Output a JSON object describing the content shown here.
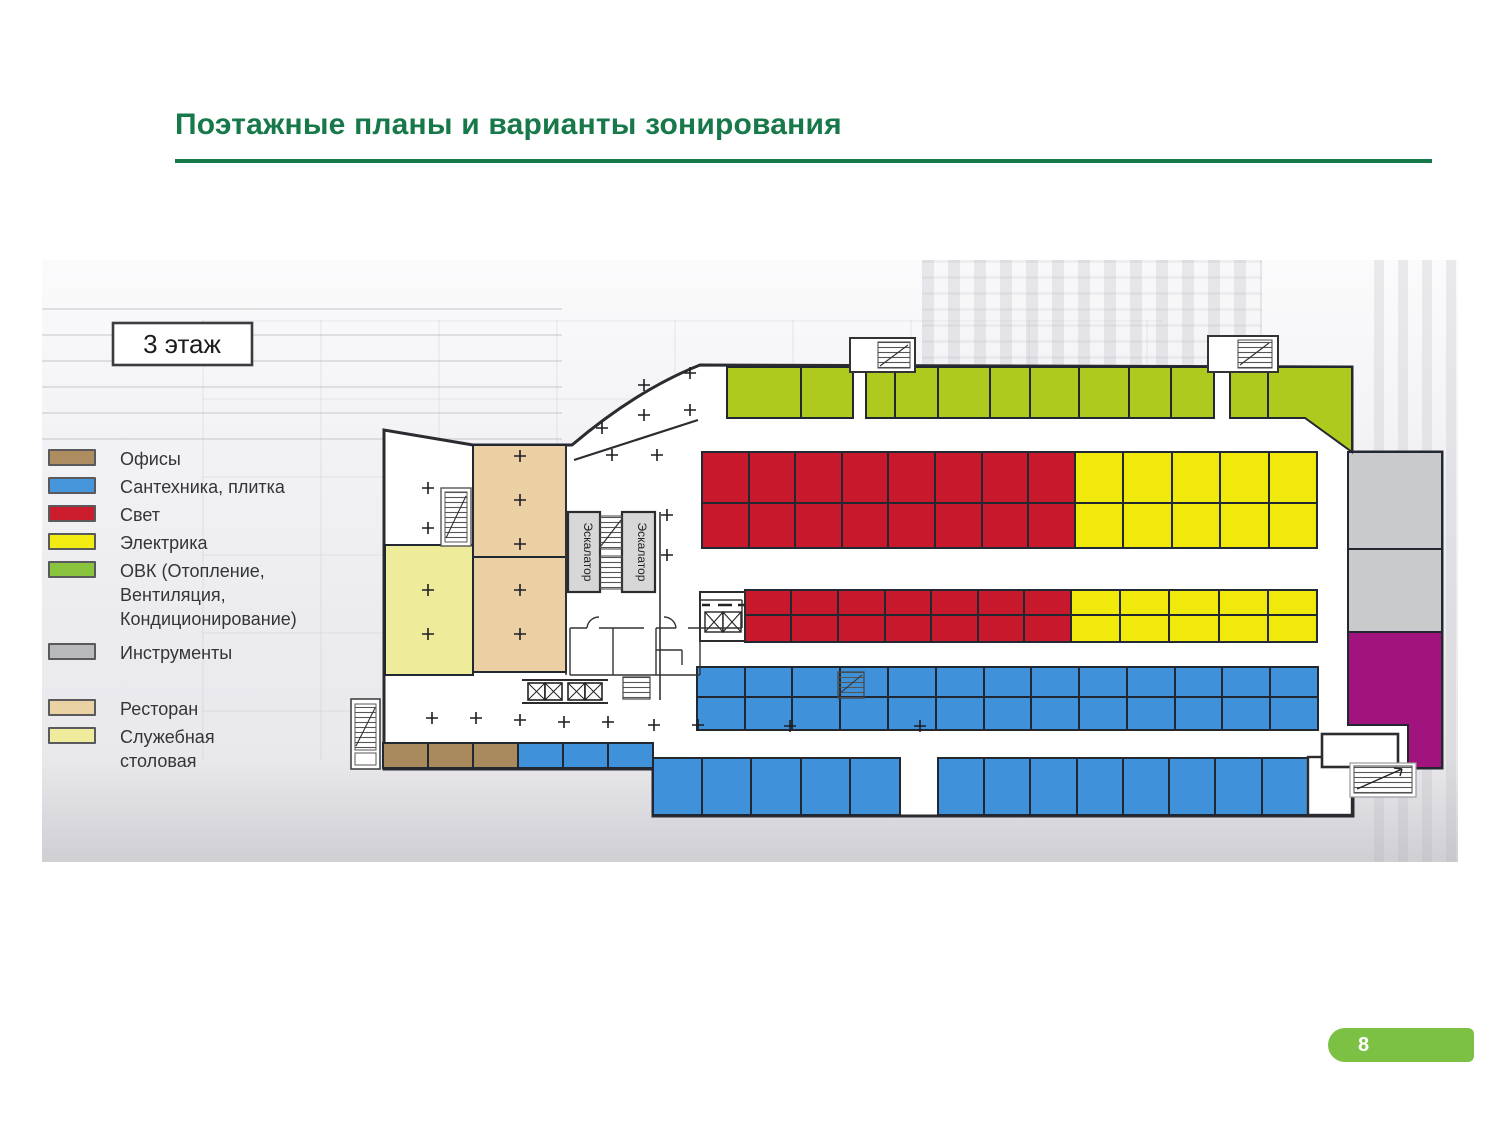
{
  "page": {
    "title": "Поэтажные планы и варианты зонирования",
    "accent_green": "#17784a",
    "badge_green": "#7cc143",
    "page_number": "8"
  },
  "plan": {
    "floor_label": "3 этаж",
    "escalator_label": "Эскалатор",
    "legend": [
      {
        "id": "offices",
        "label": "Офисы",
        "color": "#ad8c60"
      },
      {
        "id": "plumbing",
        "label": "Сантехника, плитка",
        "color": "#4796dc"
      },
      {
        "id": "light",
        "label": "Свет",
        "color": "#cb1d2e"
      },
      {
        "id": "electrical",
        "label": "Электрика",
        "color": "#f2ec12"
      },
      {
        "id": "hvac",
        "label": "ОВК (Отопление,\nВентиляция,\nКондиционирование)",
        "color": "#8ac43f"
      },
      {
        "id": "tools",
        "label": "Инструменты",
        "color": "#b9babc"
      },
      {
        "id": "restaurant",
        "label": "Ресторан",
        "color": "#ebd2a3"
      },
      {
        "id": "canteen",
        "label": "Служебная\nстоловая",
        "color": "#eeeb9d"
      }
    ],
    "zone_colors": {
      "offices": "#a98a5c",
      "plumbing": "#3f92da",
      "light": "#c8182c",
      "electrical": "#f0e90b",
      "hvac": "#aeca1e",
      "tools": "#c9cacc",
      "restaurant": "#ead0a2",
      "canteen": "#eeeb9a",
      "purple": "#a1137d"
    },
    "grids": [
      {
        "zone": "hvac",
        "rows": [
          [
            107,
            158
          ]
        ],
        "cols": [
          685,
          759,
          811
        ]
      },
      {
        "zone": "hvac",
        "rows": [
          [
            107,
            158
          ]
        ],
        "cols": [
          824,
          853,
          896,
          948,
          988,
          1037,
          1087,
          1129,
          1172
        ]
      },
      {
        "zone": "hvac",
        "rows": [
          [
            107,
            158
          ]
        ],
        "cols": [
          1188,
          1226
        ]
      },
      {
        "zone": "light",
        "rows": [
          [
            192,
            243
          ],
          [
            243,
            288
          ]
        ],
        "cols": [
          660,
          707,
          753,
          800,
          846,
          893,
          940,
          986,
          1033
        ]
      },
      {
        "zone": "electrical",
        "rows": [
          [
            192,
            243
          ],
          [
            243,
            288
          ]
        ],
        "cols": [
          1033,
          1081,
          1130,
          1178,
          1227,
          1275
        ]
      },
      {
        "zone": "light",
        "rows": [
          [
            330,
            355
          ],
          [
            355,
            382
          ]
        ],
        "cols": [
          703,
          749,
          796,
          843,
          889,
          936,
          982,
          1029
        ]
      },
      {
        "zone": "electrical",
        "rows": [
          [
            330,
            355
          ],
          [
            355,
            382
          ]
        ],
        "cols": [
          1029,
          1078,
          1127,
          1177,
          1226,
          1275
        ]
      },
      {
        "zone": "plumbing",
        "rows": [
          [
            407,
            437
          ],
          [
            437,
            470
          ]
        ],
        "cols": [
          655,
          703,
          750,
          798,
          846,
          894,
          942,
          989,
          1037,
          1085,
          1133,
          1180,
          1228,
          1276
        ]
      },
      {
        "zone": "offices",
        "rows": [
          [
            483,
            508
          ]
        ],
        "cols": [
          341,
          386,
          431,
          476
        ]
      },
      {
        "zone": "plumbing",
        "rows": [
          [
            483,
            508
          ]
        ],
        "cols": [
          476,
          521,
          566,
          611
        ]
      },
      {
        "zone": "plumbing",
        "rows": [
          [
            498,
            555
          ]
        ],
        "cols": [
          611,
          660,
          709,
          759,
          808,
          858
        ]
      },
      {
        "zone": "plumbing",
        "rows": [
          [
            498,
            555
          ]
        ],
        "cols": [
          896,
          942,
          988,
          1035,
          1081,
          1127,
          1173,
          1220,
          1266
        ]
      },
      {
        "zone": "tools",
        "rows": [
          [
            192,
            289
          ],
          [
            289,
            372
          ]
        ],
        "cols": [
          1306,
          1400
        ]
      },
      {
        "zone": "restaurant",
        "rows": [
          [
            185,
            297
          ],
          [
            297,
            412
          ]
        ],
        "cols": [
          431,
          524
        ]
      },
      {
        "zone": "canteen",
        "rows": [
          [
            285,
            415
          ]
        ],
        "cols": [
          343,
          431
        ]
      }
    ],
    "polys": [
      {
        "zone": "hvac",
        "points": "1226,107 1310,107 1310,192 1263,158 1226,158"
      },
      {
        "zone": "purple",
        "points": "1306,372 1400,372 1400,508 1366,508 1366,465 1306,465"
      }
    ]
  }
}
